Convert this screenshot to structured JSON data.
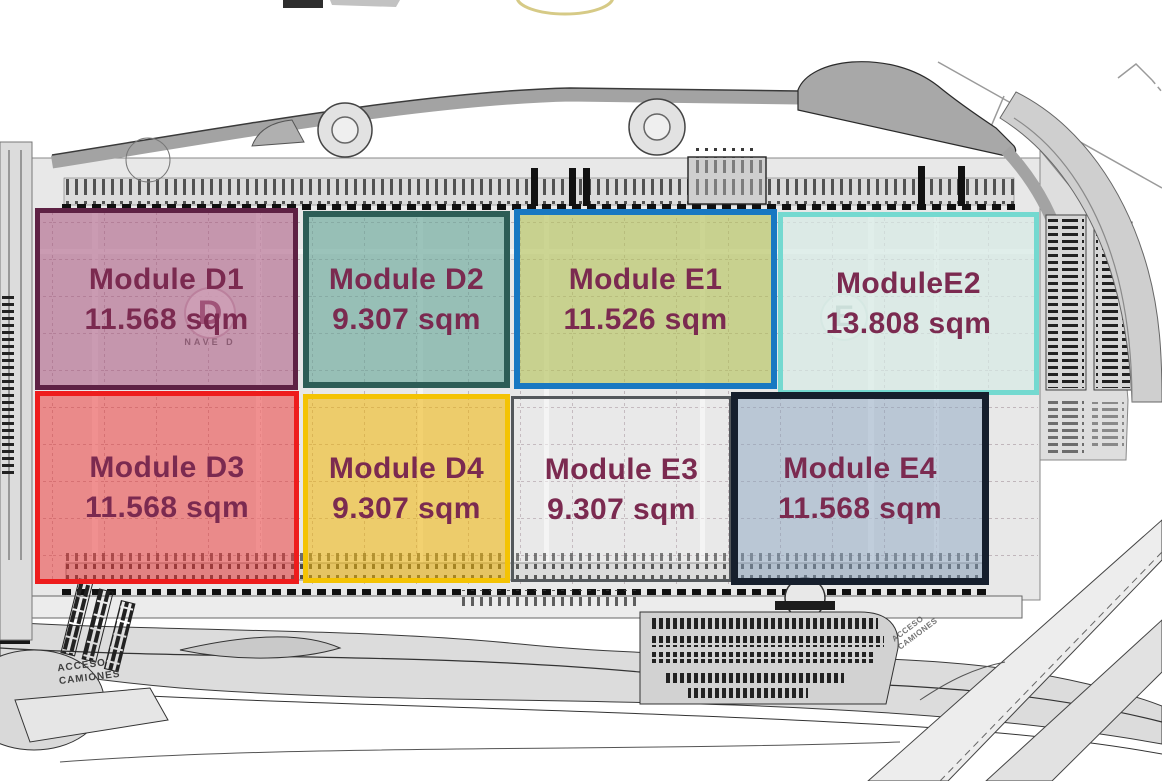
{
  "label_color": "#7b2a50",
  "modules": [
    {
      "id": "D1",
      "name": "Module D1",
      "area": "11.568 sqm",
      "fill": "rgba(167,82,124,0.55)",
      "border": "#5e2144",
      "border_px": 5
    },
    {
      "id": "D2",
      "name": "Module D2",
      "area": "9.307 sqm",
      "fill": "rgba(96,164,149,0.60)",
      "border": "#2d5d56",
      "border_px": 6
    },
    {
      "id": "E1",
      "name": "Module E1",
      "area": "11.526 sqm",
      "fill": "rgba(179,193,84,0.60)",
      "border": "#1878c2",
      "border_px": 6
    },
    {
      "id": "E2",
      "name": "ModuleE2",
      "area": "13.808 sqm",
      "fill": "rgba(215,235,230,0.70)",
      "border": "#74d9d0",
      "border_px": 5
    },
    {
      "id": "D3",
      "name": "Module D3",
      "area": "11.568 sqm",
      "fill": "rgba(236,44,44,0.50)",
      "border": "#ee1c1c",
      "border_px": 5
    },
    {
      "id": "D4",
      "name": "Module D4",
      "area": "9.307 sqm",
      "fill": "rgba(241,181,4,0.55)",
      "border": "#f4c303",
      "border_px": 5
    },
    {
      "id": "E3",
      "name": "Module E3",
      "area": "9.307 sqm",
      "fill": "rgba(255,255,255,0.08)",
      "border": "#54585c",
      "border_px": 3
    },
    {
      "id": "E4",
      "name": "Module E4",
      "area": "11.568 sqm",
      "fill": "rgba(139,165,193,0.50)",
      "border": "#161f2d",
      "border_px": 7
    }
  ],
  "plan": {
    "building_d_badge": "D",
    "building_d_caption": "NAVE D",
    "building_e_badge": "E",
    "truck_access_label": "ACCESO CAMIONES"
  }
}
